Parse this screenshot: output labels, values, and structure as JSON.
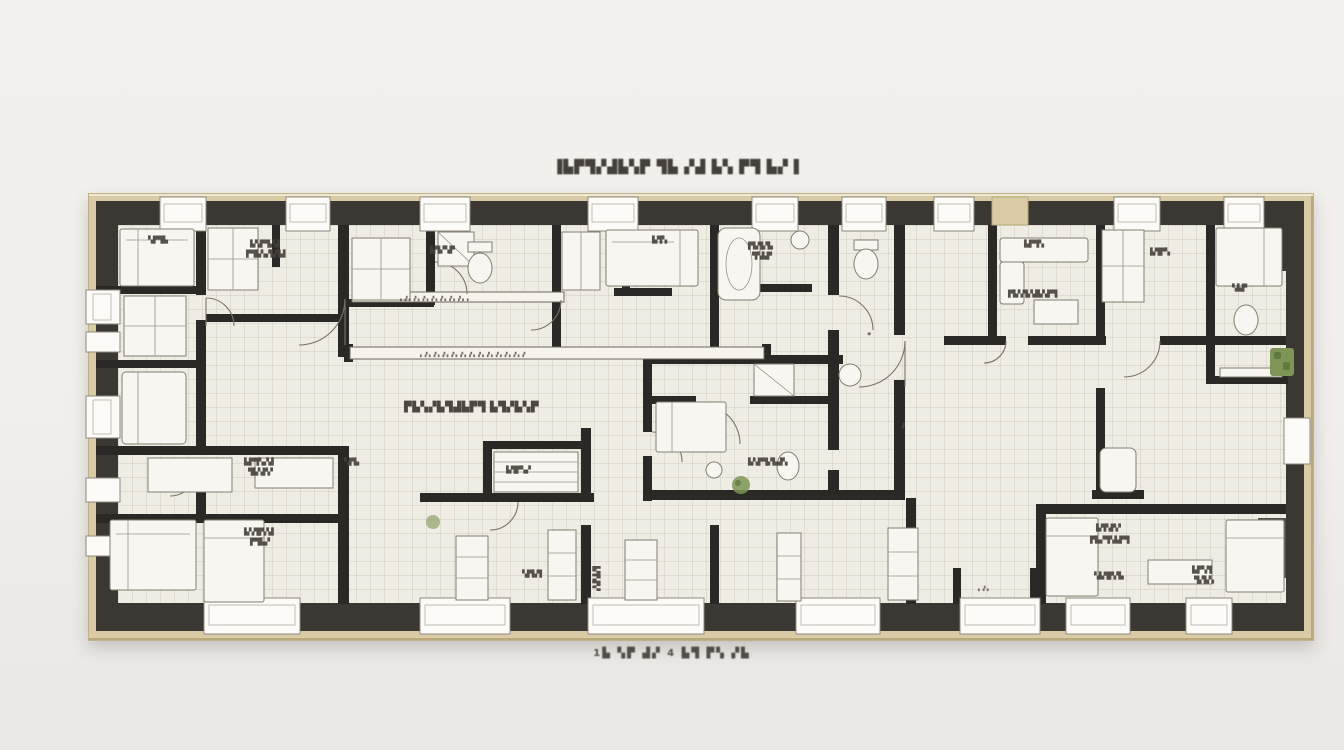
{
  "artwork": {
    "type": "framed architectural floor plan, top-down, dark poche walls on cream paper",
    "title": "▐▙▛▜▞▟▙▚▛ ▜▙ ▞▟ ▙▚ ▛▜ ▙▞▐",
    "caption": "1▙ ▚▛ ▟▞ 4 ▙▜ ▛▚ ▞▙",
    "palette": {
      "background": "#f1efec",
      "frame_wood": "#d9cba5",
      "wall_poche": "#3b3833",
      "interior_wall": "#2b2925",
      "floor_paper": "#efece4",
      "grid_line": "#7d7058",
      "furniture_stroke": "#857f72",
      "window_fill": "#fcfbf8",
      "plant_green": "#7d9556",
      "label_ink": "#45413a"
    },
    "labels": [
      "▙▚▛▜▞▟",
      "▛▜▙▚▞▙▜▟",
      "▚▛▜▙",
      "▙▜▞▚▛",
      "▛▙▜▞▙",
      "▜▚▙▛",
      "▙▛▜▚",
      "▛▙▚▜▞▟▙▚▛▜",
      "▙▜▛▚",
      "▚▙▛",
      "▖▗▘▖▗▘▖▗▘▖▗▘▖▗▘▖▗▘▖▗▘▖▗",
      "▖▗▘▖▗▘▖▗▘▖▗▘▖▗▘▖▗▘▖▗▘▖▗▘▖▗▘▖▗▘▖▗▘▖▗▘",
      "▛▙▚▞▙▜▟▙▛▜ ▙▜▞▙▚▛",
      "▙▚▛▜▞▙▟▚",
      "▙▜▛▚▞",
      "▚▛▙",
      "▙▛▜▚▞▟",
      "▜▙▚▛▞",
      "▙▚▜▛▞▟",
      "▛▜▙▞",
      "▙▜▚▛▞",
      "▛▙▞▜▚▙▛▜",
      "▚▙▜▛▞▙",
      "▙▛▚▜",
      "▜▞▙▚",
      "▖▗▘▖",
      "▗▘",
      "▗▖",
      "▙▜▚▛▞",
      "▚▛▙▜",
      "▙▜▚"
    ]
  }
}
